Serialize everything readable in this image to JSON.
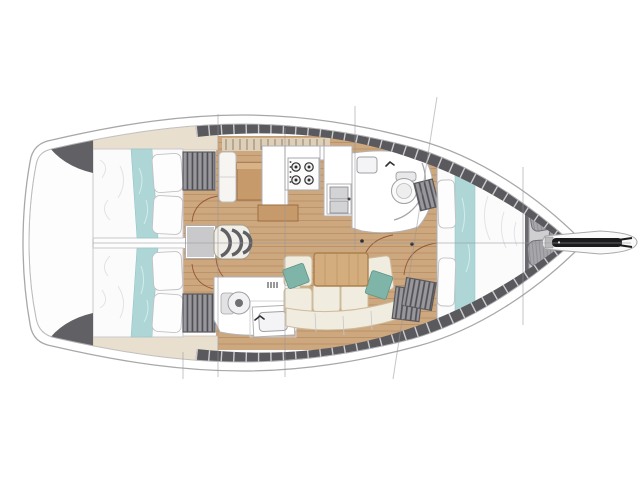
{
  "canvas": {
    "width": 640,
    "height": 480
  },
  "figure": {
    "kind": "sailboat-interior-floor-plan",
    "orientation": "bow-right"
  },
  "colors": {
    "background": "#ffffff",
    "hull_outline": "#a8a8aa",
    "deck_dark": "#5a5a5e",
    "wood_sole": "#cda77d",
    "wood_furniture": "#c79a6b",
    "table_wood": "#d4ad7e",
    "upholstery_cream": "#f1ece0",
    "bedding_white": "#fbfbfc",
    "accent_teal": "#aed6d6",
    "pillow_teal": "#7fb5a8",
    "locker_grey": "#98989c",
    "line_grey": "#97979a",
    "anchor_black": "#1c1c1e"
  },
  "elements": [
    {
      "id": "aft-cabin-port",
      "type": "double-berth"
    },
    {
      "id": "aft-cabin-starboard",
      "type": "double-berth"
    },
    {
      "id": "companionway-steps",
      "type": "stairs"
    },
    {
      "id": "chart-table",
      "type": "nav-station"
    },
    {
      "id": "galley",
      "type": "stove-and-twin-sinks"
    },
    {
      "id": "forward-head",
      "type": "toilet-shower"
    },
    {
      "id": "aft-head",
      "type": "toilet-vanity"
    },
    {
      "id": "saloon",
      "type": "u-settee-with-table"
    },
    {
      "id": "forward-cabin",
      "type": "v-berth"
    },
    {
      "id": "anchor-locker",
      "type": "fender-stowage"
    },
    {
      "id": "bow-roller",
      "type": "anchor-arm"
    }
  ],
  "section_lines": [
    {
      "x1": 183,
      "y1": 352,
      "x2": 183,
      "y2": 379
    },
    {
      "x1": 218,
      "y1": 114,
      "x2": 218,
      "y2": 377
    },
    {
      "x1": 285,
      "y1": 128,
      "x2": 285,
      "y2": 377
    },
    {
      "x1": 355,
      "y1": 106,
      "x2": 355,
      "y2": 250
    },
    {
      "x1": 437,
      "y1": 97,
      "x2": 393,
      "y2": 379
    },
    {
      "x1": 523,
      "y1": 167,
      "x2": 523,
      "y2": 325
    }
  ],
  "centerline": {
    "x1": 93,
    "y1": 243,
    "x2": 631,
    "y2": 243
  }
}
